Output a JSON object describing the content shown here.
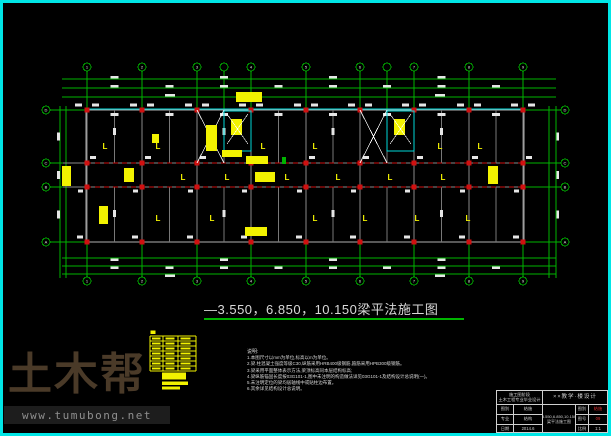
{
  "title": {
    "text": "—3.550，6.850，10.150梁平法施工图"
  },
  "watermark": {
    "brand": "土木帮",
    "url": "www.tumubong.net"
  },
  "notes": {
    "heading": "说明:",
    "items": [
      "1.本图尺寸以mm为单位,标高以m为单位。",
      "2.梁.柱混凝土强度等级C30,纵筋采用HRB400级钢筋,箍筋采用HPB300级钢筋。",
      "3.梁采用平面整体表示方法,梁顶标高同本层结构标高;",
      "4.梁纵筋锚固长度按03G101-1,图中未注明的构造做法详见03G101-1及结构设计总说明(一)。",
      "5.未注明定位的梁均居轴线中或贴柱边布置。",
      "6.其余详见结构设计总说明。"
    ]
  },
  "titleblock": {
    "org1": "施工图阶段",
    "org2": "土木工程专业毕业设计",
    "project": "××教学·楼设计",
    "drawing_name": "3.550,6.850,10.150梁平法施工图",
    "left": [
      {
        "label": "图别",
        "value": "结施"
      },
      {
        "label": "专业",
        "value": "结构"
      },
      {
        "label": "日期",
        "value": "2014.6"
      }
    ],
    "right": [
      {
        "label": "图别",
        "value": "结施"
      },
      {
        "label": "图号",
        "value": "09"
      },
      {
        "label": "比例",
        "value": "1:1"
      }
    ]
  },
  "drawing": {
    "colors": {
      "green": "#00b400",
      "beam": "#b0b0b0",
      "innerBeam": "#8a8a8a",
      "midBeam": "#787878",
      "red": "#d01010",
      "yellow": "#f2f200",
      "cyan": "#00d8d8",
      "white": "#e6e6e6"
    },
    "vx": [
      87,
      142,
      197,
      251,
      306,
      360,
      414,
      469,
      523
    ],
    "vlabels": [
      "1",
      "2",
      "3",
      "4",
      "5",
      "6",
      "7",
      "8",
      "9"
    ],
    "vsub": [
      224,
      387
    ],
    "hy": [
      110,
      163,
      187,
      242
    ],
    "hlabels": [
      "D",
      "C",
      "B",
      "A"
    ],
    "circles": {
      "topY": 67,
      "botY": 281,
      "leftX": 46,
      "rightX": 565,
      "r": 4
    },
    "building": {
      "x1": 86,
      "y1": 110,
      "x2": 524,
      "y2": 242,
      "cor1": 163,
      "cor2": 187
    },
    "dims": {
      "top": [
        79,
        88,
        97
      ],
      "bot": [
        258,
        266,
        274
      ],
      "left": [
        60,
        66
      ],
      "right": [
        549,
        556
      ],
      "spanX1": 62,
      "spanX2": 556,
      "spanY1": 106,
      "spanY2": 278
    },
    "stairs": [
      {
        "bx1": 197,
        "bx2": 224,
        "wx": 224,
        "ww": 27
      },
      {
        "bx1": 360,
        "bx2": 387,
        "wx": 387,
        "ww": 27
      }
    ],
    "yellow_blocks": [
      [
        236,
        92,
        26,
        10
      ],
      [
        206,
        125,
        11,
        26
      ],
      [
        222,
        150,
        20,
        7
      ],
      [
        246,
        156,
        22,
        8
      ],
      [
        255,
        172,
        20,
        10
      ],
      [
        62,
        166,
        9,
        20
      ],
      [
        124,
        168,
        10,
        14
      ],
      [
        99,
        206,
        9,
        18
      ],
      [
        245,
        227,
        22,
        9
      ],
      [
        488,
        166,
        10,
        18
      ],
      [
        152,
        134,
        7,
        9
      ]
    ],
    "label_char": "L",
    "yellow_labels": {
      "top": {
        "y": 149,
        "xs": [
          105,
          158,
          263,
          315,
          440,
          480
        ]
      },
      "corridor": {
        "y": 180,
        "xs": [
          130,
          183,
          227,
          287,
          338,
          390,
          443
        ]
      },
      "bottom": {
        "y": 221,
        "xs": [
          158,
          212,
          315,
          365,
          417,
          468
        ]
      }
    },
    "legend": {
      "x1": 150,
      "x2": 196,
      "yTop": 336,
      "rows": 7,
      "rowH": 5,
      "vxs": [
        150,
        163,
        178,
        196
      ]
    }
  }
}
